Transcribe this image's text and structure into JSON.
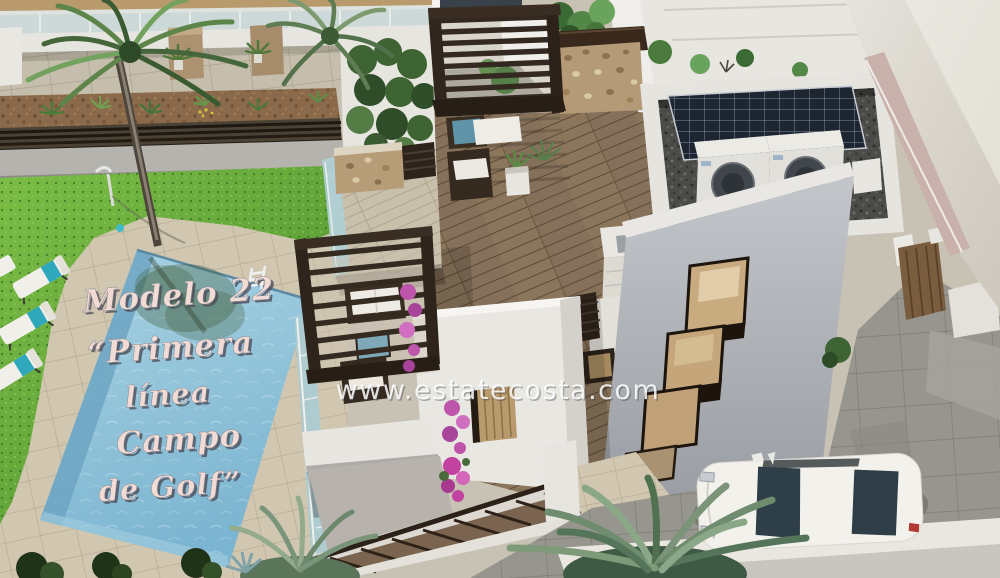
{
  "watermark": "www.estatecosta.com",
  "pool_label": {
    "line1": "Modelo 22",
    "line2": "“Primera",
    "line3": "línea",
    "line4": "Campo",
    "line5": "de Golf”"
  },
  "palette": {
    "lawn_green": "#5fa337",
    "pool_water": "#8fc3da",
    "pool_step": "#6da5c2",
    "deck_tile_beige": "#d1c7b1",
    "wood_deck_brown": "#85705a",
    "pergola_dark_brown": "#342920",
    "villa_white": "#ecebe6",
    "villa_gray_wall": "#aeb2b7",
    "stone_wall_tan": "#b49a77",
    "driveway_gray": "#96968e",
    "solar_panel_navy": "#1d2531",
    "ac_unit_white": "#e9e7e2",
    "towel_teal": "#2fa8bb",
    "bougainvillea_pink": "#bd55aa",
    "label_pink_white": "#f2dbd4",
    "watermark_white": "#ffffff"
  }
}
